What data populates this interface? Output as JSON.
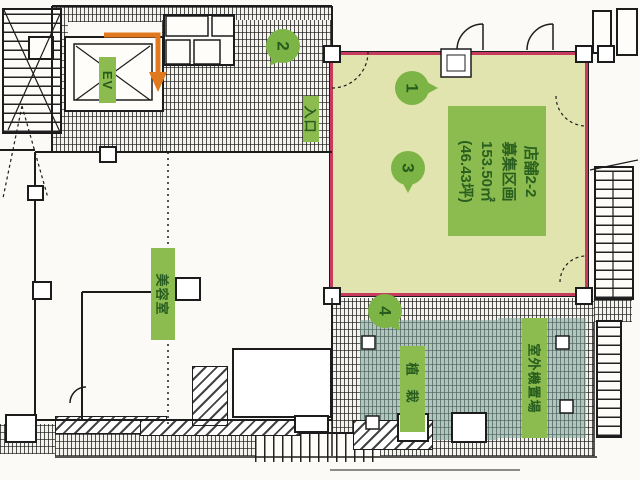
{
  "parcel": {
    "title": "店舗2-2",
    "subtitle": "募集区画",
    "area_m2": "153.50㎡",
    "area_tsubo": "(46.43坪)"
  },
  "labels": {
    "elevator": "EV",
    "entrance": "入口",
    "beauty_salon": "美容室",
    "planting": "植栽",
    "outdoor_unit_area": "室外機置場"
  },
  "markers": {
    "m1": "1",
    "m2": "2",
    "m3": "3",
    "m4": "4"
  },
  "colors": {
    "parcel_fill": "#e1e4ae",
    "parcel_border": "#c73c5e",
    "label_green": "#8cbb4f",
    "marker_green": "#7cb445",
    "text_dark_green": "#265c1e",
    "teal_overlay": "#7aa398",
    "arrow_orange": "#e0791e"
  }
}
